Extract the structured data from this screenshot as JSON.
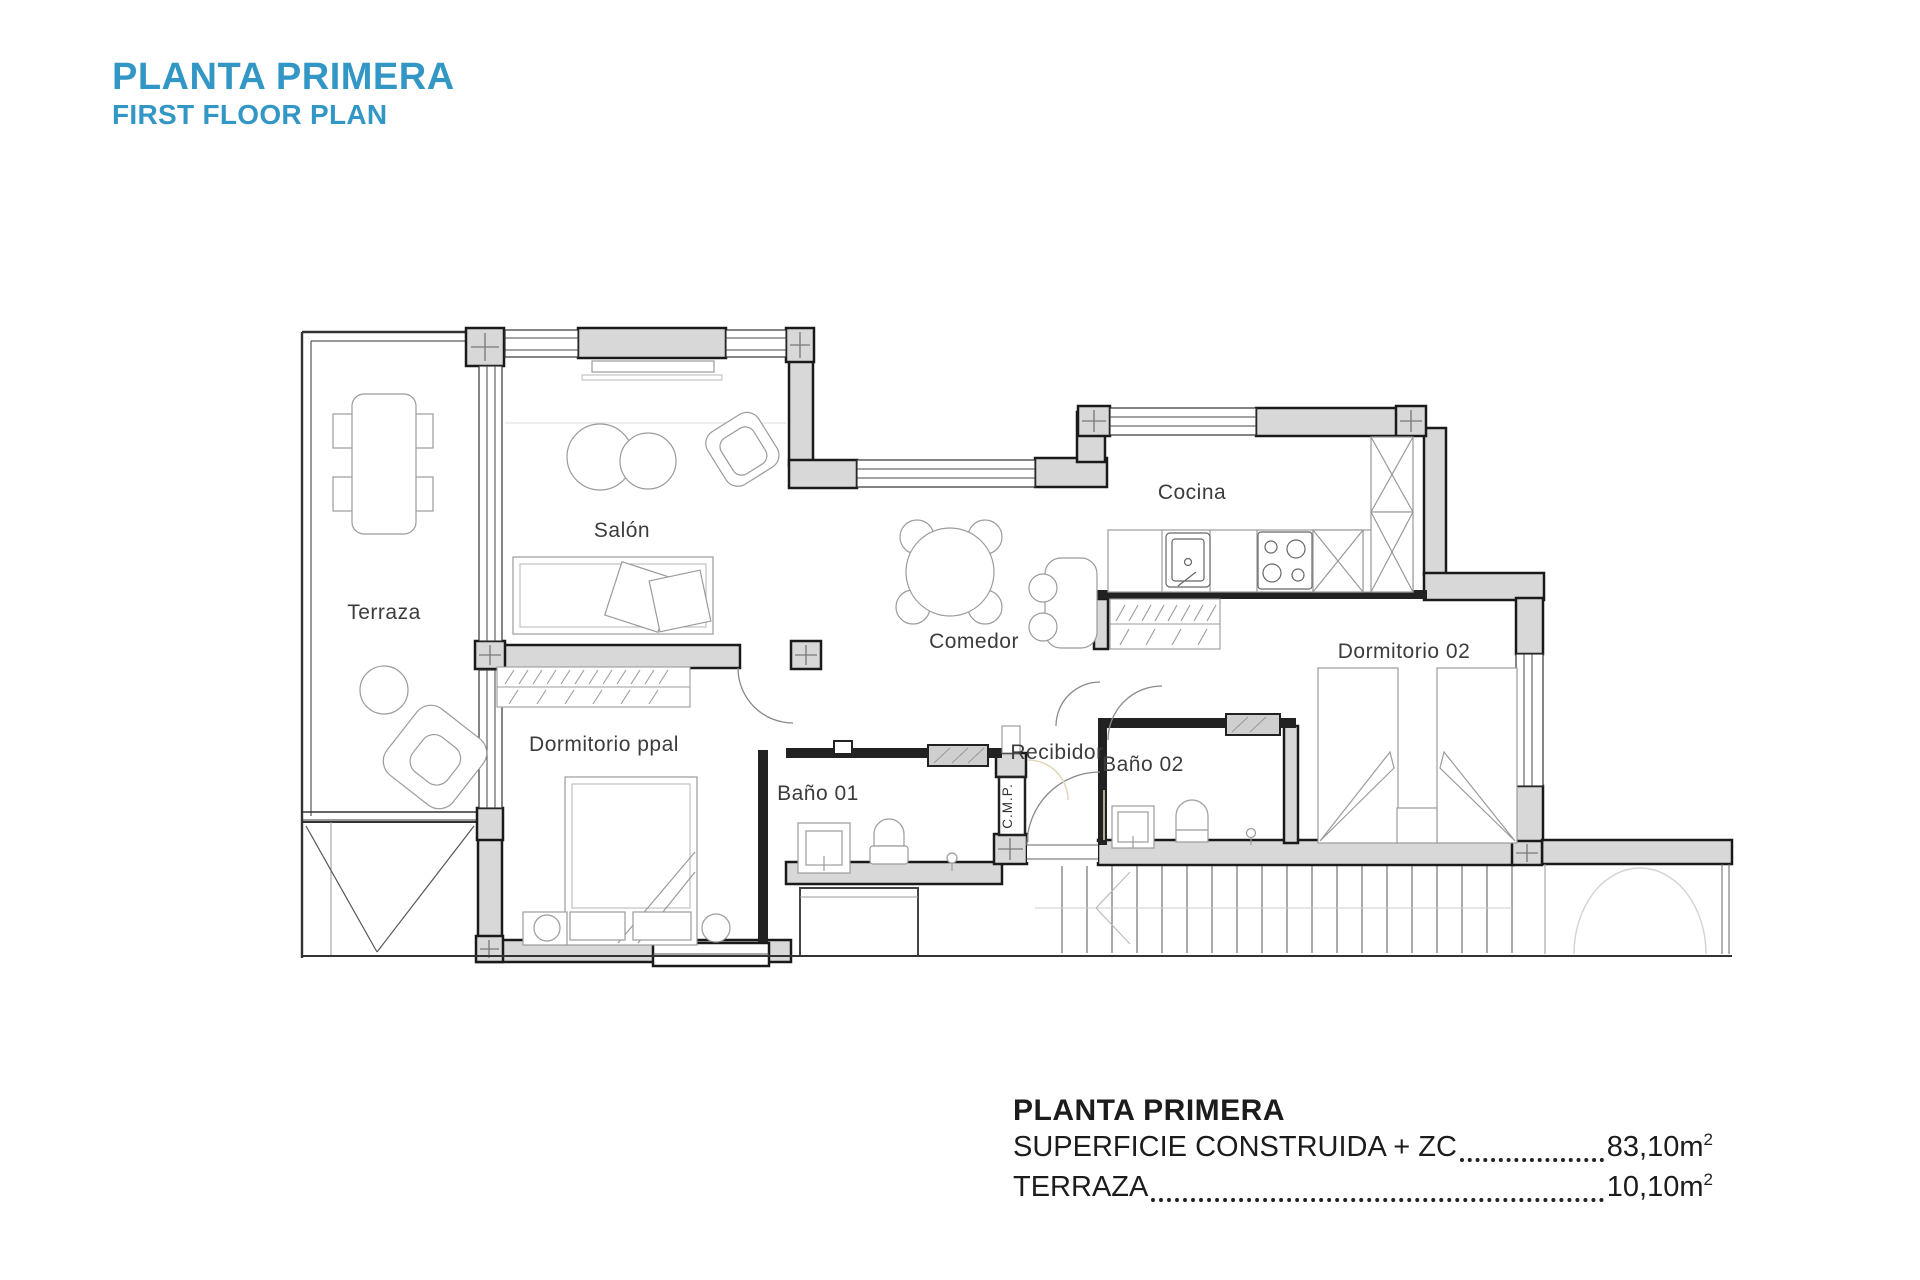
{
  "header": {
    "title": "PLANTA PRIMERA",
    "subtitle": "FIRST FLOOR PLAN"
  },
  "plan": {
    "rooms": {
      "terraza": "Terraza",
      "salon": "Salón",
      "comedor": "Comedor",
      "cocina": "Cocina",
      "dormitorio02": "Dormitorio 02",
      "dormitorio_ppal": "Dormitorio ppal",
      "bano01": "Baño 01",
      "bano02": "Baño 02",
      "recibidor": "Recibidor",
      "cmp": "C.M.P."
    }
  },
  "summary": {
    "heading": "PLANTA PRIMERA",
    "rows": [
      {
        "label": "SUPERFICIE CONSTRUIDA + ZC",
        "value": "83,10m",
        "exp": "2"
      },
      {
        "label": "TERRAZA",
        "value": "10,10m",
        "exp": "2"
      }
    ]
  },
  "colors": {
    "accent": "#3397c6",
    "wall_fill": "#d8d8d8",
    "wall_stroke": "#1a1a1a",
    "interior_wall": "#222222",
    "furniture_stroke": "#9b9b9b",
    "label_color": "#3c3c3c"
  }
}
